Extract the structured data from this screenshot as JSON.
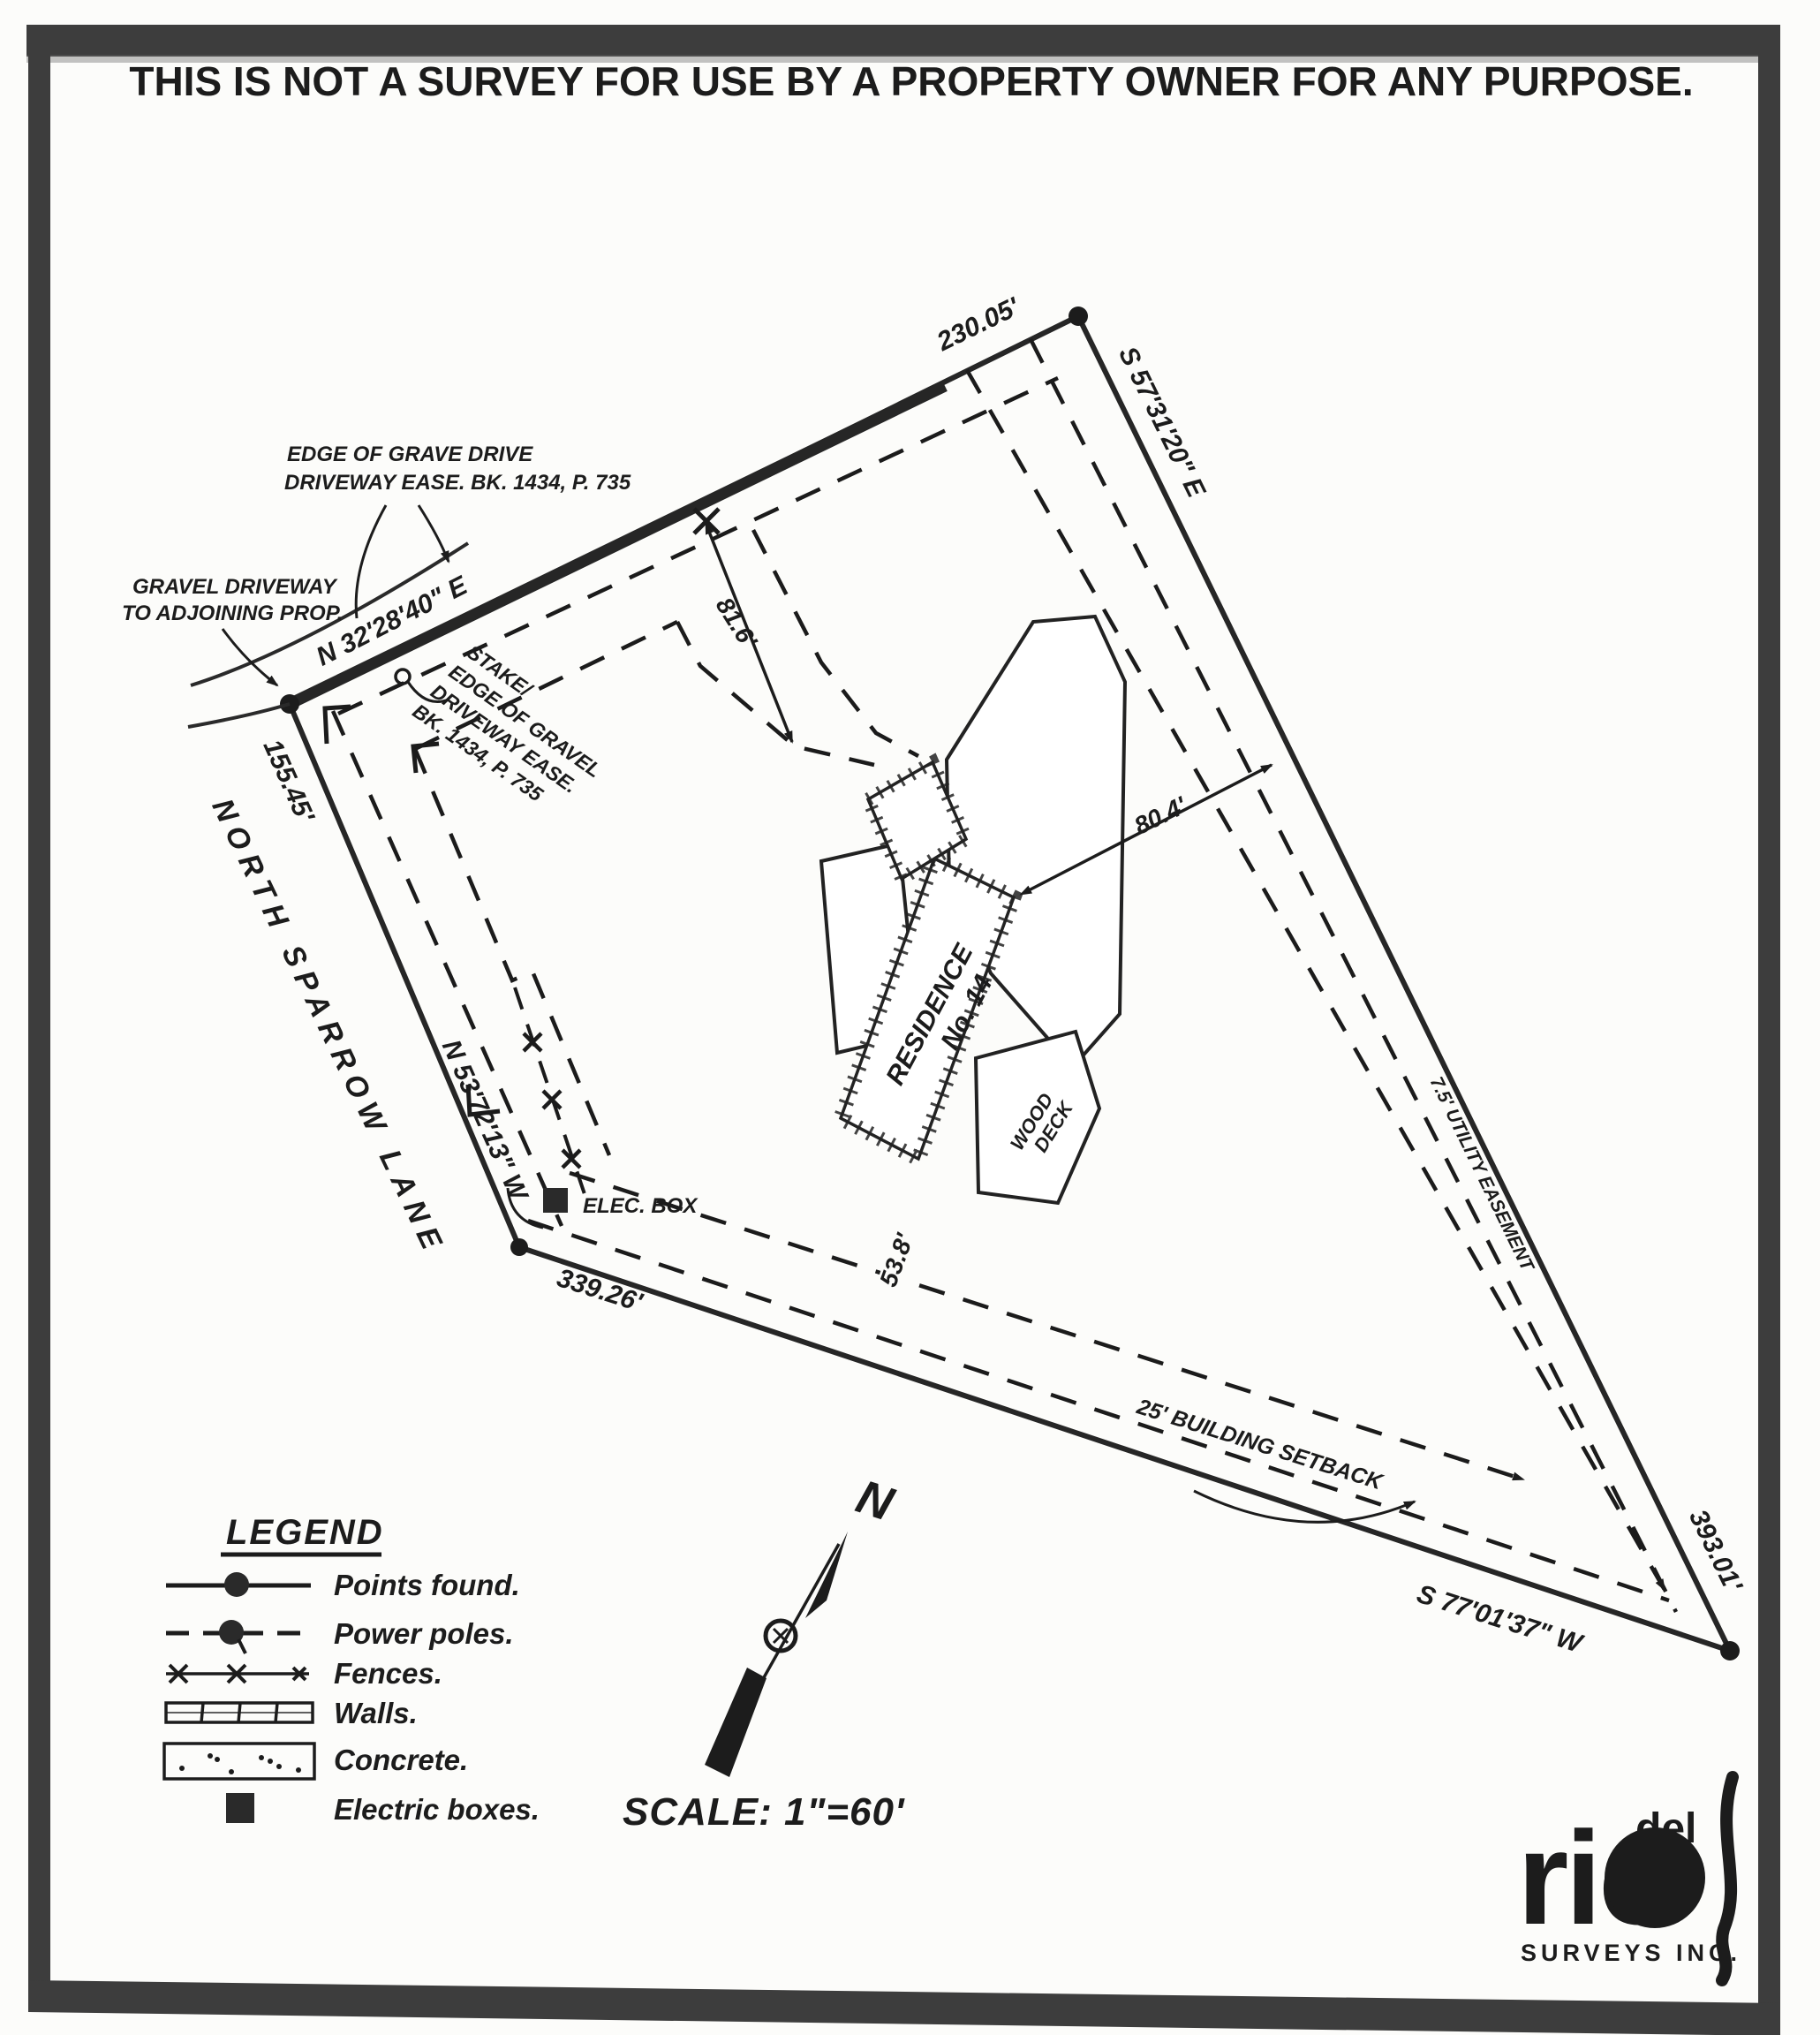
{
  "title": "THIS IS NOT A SURVEY FOR USE BY A PROPERTY OWNER FOR ANY PURPOSE.",
  "boundaries": {
    "northwest_line": {
      "bearing": "N 32'28'40\" E",
      "distance": "230.05'"
    },
    "northeast_line": {
      "bearing": "S 57'31'20\" E",
      "distance": "393.01'"
    },
    "south_line": {
      "bearing": "S 77'01'37\" W",
      "distance": "339.26'"
    },
    "road_line": {
      "bearing": "N 53'72'13\" W",
      "distance": "155.45'"
    }
  },
  "annotations": {
    "edge_of_drive_1": "EDGE OF GRAVE DRIVE",
    "edge_of_drive_2": "DRIVEWAY EASE. BK. 1434, P. 735",
    "gravel_driveway_1": "GRAVEL DRIVEWAY",
    "gravel_driveway_2": "TO ADJOINING PROP.",
    "stake": [
      "STAKE/",
      "EDGE OF GRAVEL",
      "DRIVEWAY EASE.",
      "BK. 1434, P. 735"
    ],
    "street": "NORTH SPARROW LANE",
    "elec_box": "ELEC. BOX",
    "utility_easement": "7.5' UTILITY EASEMENT",
    "building_setback": "25' BUILDING SETBACK",
    "residence_1": "RESIDENCE",
    "residence_2": "No. 14",
    "wood_deck_1": "WOOD",
    "wood_deck_2": "DECK"
  },
  "dimensions": {
    "house_to_north": "81.6'",
    "house_to_east": "80.4'",
    "house_to_south": "53.8'"
  },
  "legend": {
    "title": "LEGEND",
    "items": [
      {
        "symbol": "points-found-symbol",
        "label": "Points found."
      },
      {
        "symbol": "power-poles-symbol",
        "label": "Power poles."
      },
      {
        "symbol": "fences-symbol",
        "label": "Fences."
      },
      {
        "symbol": "walls-symbol",
        "label": "Walls."
      },
      {
        "symbol": "concrete-symbol",
        "label": "Concrete."
      },
      {
        "symbol": "electric-boxes-symbol",
        "label": "Electric boxes."
      }
    ]
  },
  "north_arrow": "N",
  "scale": "SCALE: 1\"=60'",
  "logo": {
    "top": "del",
    "main": "rio",
    "sub": "SURVEYS INC."
  }
}
